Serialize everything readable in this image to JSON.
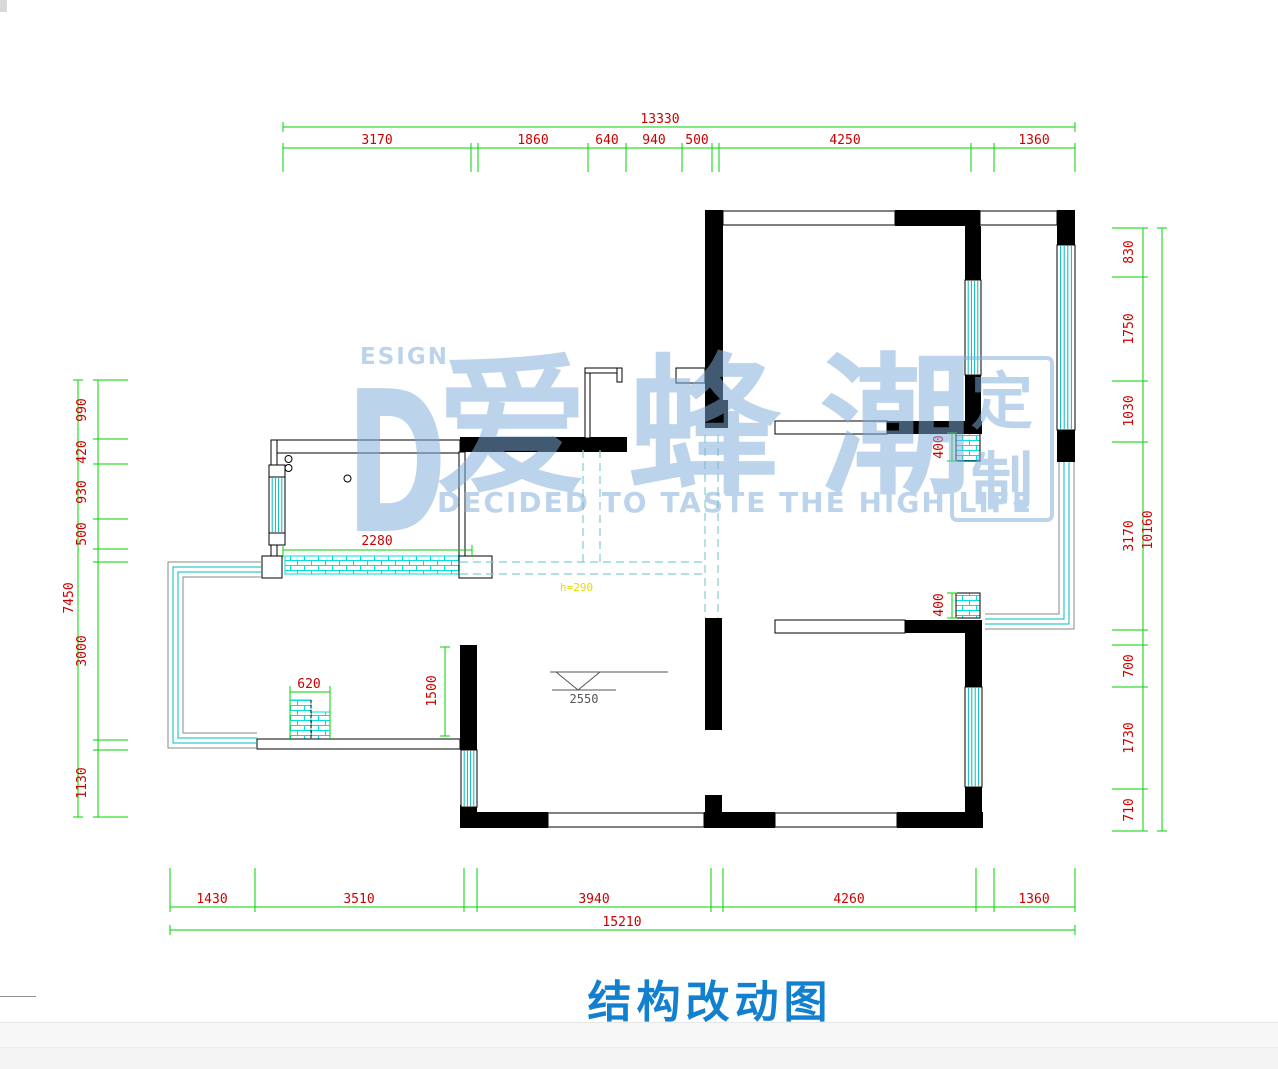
{
  "page": {
    "background": "#ffffff"
  },
  "title": {
    "text": "结构改动图",
    "color": "#1280cf"
  },
  "watermark": {
    "brand_d": "D",
    "brand_esign": "ESIGN",
    "brand_cjk": "爱蜂潮",
    "stamp_top": "定",
    "stamp_bottom": "制",
    "slogan": "DECIDED TO TASTE THE HIGH LIFE",
    "color": "#7fadd9"
  },
  "palette": {
    "wall": "#000000",
    "dim_line": "#00d400",
    "dim_text": "#cc0000",
    "window": "#00bcbc",
    "hatch": "#00dede",
    "dashed": "#82cdcd",
    "note_yellow": "#e8dc00",
    "marker_gray": "#555555",
    "bay_gray": "#8a8a8a"
  },
  "dimensions": {
    "top": {
      "total": "13330",
      "segments": [
        "3170",
        "1860",
        "640",
        "940",
        "500",
        "4250",
        "1360"
      ]
    },
    "bottom": {
      "total": "15210",
      "segments": [
        "1430",
        "3510",
        "3940",
        "4260",
        "1360"
      ]
    },
    "left": {
      "total": "7450",
      "segments": [
        "990",
        "420",
        "930",
        "500",
        "3000",
        "1130"
      ]
    },
    "right": {
      "total": "10160",
      "segments": [
        "830",
        "1750",
        "1030",
        "3170",
        "700",
        "1730",
        "710"
      ]
    },
    "interior": {
      "new_wall_top": "2280",
      "new_wall_left": "620",
      "opening_left": "1500",
      "niche_upper": "400",
      "niche_lower": "400"
    },
    "level_marker": "2550",
    "beam_note": "h=290"
  }
}
